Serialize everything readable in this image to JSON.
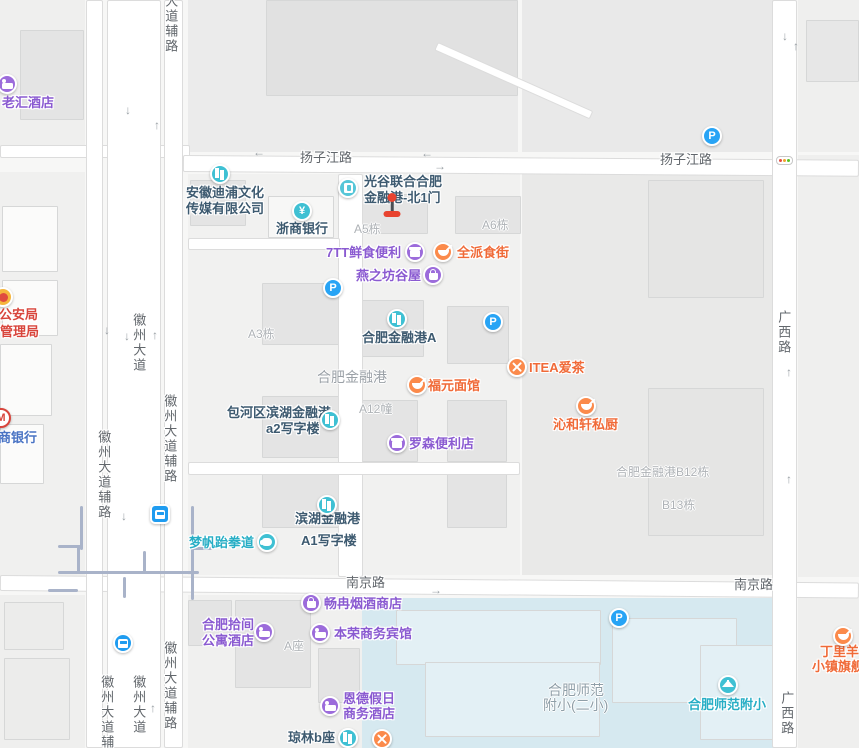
{
  "title": "合肥金融港地图",
  "colors": {
    "base": "#f7f7f6",
    "road_fill": "#ffffff",
    "road_edge": "#dcdcdc",
    "metro_line": "#a9b3c9",
    "road_label": "#62676c",
    "gray_label": "#aeb2b6",
    "area_label": "#9ba1a7",
    "school_label": "#8f9fa8",
    "marker_red": "#e8432f",
    "marker_stem": "#4a4f54",
    "tl_red": "#e54d42",
    "tl_yellow": "#f0a32f",
    "tl_green": "#58c322",
    "parking_blue": "#28a4f5",
    "mbank_red": "#d8453c"
  },
  "schemes": {
    "purple": {
      "icon": "#9c6cdb",
      "text": "#8a5ad1"
    },
    "orange": {
      "icon": "#fb8a4b",
      "text": "#f06a38"
    },
    "teal": {
      "icon": "#3fc0d3",
      "text": "#27aec5"
    },
    "dark": {
      "icon": "#3fc0d3",
      "text": "#3d5a70"
    },
    "red": {
      "icon": "#f5b53d",
      "text": "#d8453c"
    },
    "blue": {
      "icon": "#ffffff",
      "text": "#4a74c4"
    },
    "transit": {
      "icon": "#1f9cf0",
      "text": "#1f9cf0"
    }
  },
  "glyph_chars": {
    "yen": "¥",
    "parking": "P",
    "mbank": "M"
  },
  "arrow_chars": {
    "u": "↑",
    "d": "↓",
    "l": "←",
    "r": "→"
  },
  "blocks": [
    {
      "x": 0,
      "y": 0,
      "w": 85,
      "h": 148,
      "c": "#efefee"
    },
    {
      "x": 188,
      "y": 0,
      "w": 330,
      "h": 152,
      "c": "#ebebeb"
    },
    {
      "x": 522,
      "y": 0,
      "w": 252,
      "h": 152,
      "c": "#e9e9e9"
    },
    {
      "x": 798,
      "y": 0,
      "w": 61,
      "h": 152,
      "c": "#efefee"
    },
    {
      "x": 0,
      "y": 172,
      "w": 85,
      "h": 405,
      "c": "#f0f0ef"
    },
    {
      "x": 188,
      "y": 174,
      "w": 332,
      "h": 401,
      "c": "#f1f1f0"
    },
    {
      "x": 522,
      "y": 172,
      "w": 250,
      "h": 403,
      "c": "#e9e9e8"
    },
    {
      "x": 798,
      "y": 155,
      "w": 61,
      "h": 422,
      "c": "#efefee"
    },
    {
      "x": 0,
      "y": 595,
      "w": 85,
      "h": 153,
      "c": "#efefee"
    },
    {
      "x": 188,
      "y": 595,
      "w": 174,
      "h": 153,
      "c": "#f0f0ef"
    },
    {
      "x": 362,
      "y": 598,
      "w": 413,
      "h": 150,
      "c": "#d6e9f0"
    },
    {
      "x": 798,
      "y": 598,
      "w": 61,
      "h": 150,
      "c": "#efefee"
    }
  ],
  "buildings": [
    {
      "x": 20,
      "y": 30,
      "w": 64,
      "h": 90
    },
    {
      "x": 266,
      "y": 0,
      "w": 252,
      "h": 96,
      "c": "#e1e1e1"
    },
    {
      "x": 806,
      "y": 20,
      "w": 53,
      "h": 62,
      "c": "#e7e7e7"
    },
    {
      "x": 2,
      "y": 206,
      "w": 56,
      "h": 66,
      "c": "#fbfbfa"
    },
    {
      "x": 2,
      "y": 280,
      "w": 56,
      "h": 56,
      "c": "#fbfbfa"
    },
    {
      "x": 0,
      "y": 344,
      "w": 52,
      "h": 72,
      "c": "#fbfbfa"
    },
    {
      "x": 0,
      "y": 424,
      "w": 44,
      "h": 60,
      "c": "#fbfbfa"
    },
    {
      "x": 190,
      "y": 180,
      "w": 56,
      "h": 46
    },
    {
      "x": 268,
      "y": 196,
      "w": 66,
      "h": 42,
      "c": "#f7f7f6"
    },
    {
      "x": 352,
      "y": 194,
      "w": 76,
      "h": 40
    },
    {
      "x": 455,
      "y": 196,
      "w": 66,
      "h": 38
    },
    {
      "x": 262,
      "y": 283,
      "w": 78,
      "h": 62
    },
    {
      "x": 362,
      "y": 300,
      "w": 62,
      "h": 57
    },
    {
      "x": 447,
      "y": 306,
      "w": 62,
      "h": 58
    },
    {
      "x": 262,
      "y": 396,
      "w": 78,
      "h": 62
    },
    {
      "x": 358,
      "y": 400,
      "w": 60,
      "h": 62
    },
    {
      "x": 447,
      "y": 400,
      "w": 60,
      "h": 62
    },
    {
      "x": 262,
      "y": 468,
      "w": 78,
      "h": 60
    },
    {
      "x": 447,
      "y": 468,
      "w": 60,
      "h": 60
    },
    {
      "x": 648,
      "y": 180,
      "w": 116,
      "h": 118,
      "c": "#e5e5e4"
    },
    {
      "x": 648,
      "y": 388,
      "w": 116,
      "h": 148,
      "c": "#e5e5e4"
    },
    {
      "x": 235,
      "y": 600,
      "w": 76,
      "h": 88
    },
    {
      "x": 188,
      "y": 600,
      "w": 44,
      "h": 46
    },
    {
      "x": 318,
      "y": 648,
      "w": 42,
      "h": 55
    },
    {
      "x": 4,
      "y": 602,
      "w": 60,
      "h": 48,
      "c": "#ececeb"
    },
    {
      "x": 4,
      "y": 658,
      "w": 66,
      "h": 82,
      "c": "#ececeb"
    },
    {
      "x": 396,
      "y": 610,
      "w": 205,
      "h": 55,
      "c": "#e3f0f5"
    },
    {
      "x": 425,
      "y": 662,
      "w": 175,
      "h": 75,
      "c": "#e3f0f5"
    },
    {
      "x": 612,
      "y": 618,
      "w": 125,
      "h": 85,
      "c": "#e3f0f5"
    },
    {
      "x": 700,
      "y": 645,
      "w": 85,
      "h": 95,
      "c": "#e3f0f5"
    }
  ],
  "roads": [
    {
      "x": 0,
      "y": 145,
      "w": 190,
      "h": 13,
      "r": 0
    },
    {
      "x": 183,
      "y": 155,
      "w": 676,
      "h": 17,
      "r": 0.4
    },
    {
      "x": 0,
      "y": 575,
      "w": 859,
      "h": 16,
      "r": 0.5
    },
    {
      "x": 86,
      "y": 0,
      "w": 17,
      "h": 748,
      "r": 0
    },
    {
      "x": 107,
      "y": 0,
      "w": 54,
      "h": 748,
      "r": 0
    },
    {
      "x": 164,
      "y": 0,
      "w": 19,
      "h": 748,
      "r": 0
    },
    {
      "x": 772,
      "y": 0,
      "w": 25,
      "h": 748,
      "r": 0
    },
    {
      "x": 338,
      "y": 174,
      "w": 25,
      "h": 403,
      "r": 0
    },
    {
      "x": 188,
      "y": 238,
      "w": 152,
      "h": 12,
      "r": 0
    },
    {
      "x": 188,
      "y": 462,
      "w": 332,
      "h": 13,
      "r": 0
    },
    {
      "x": 438,
      "y": 42,
      "w": 170,
      "h": 9,
      "r": 24
    }
  ],
  "metro_lines": [
    {
      "x": 80,
      "y": 506,
      "w": 3,
      "h": 44
    },
    {
      "x": 58,
      "y": 545,
      "w": 23,
      "h": 3
    },
    {
      "x": 77,
      "y": 547,
      "w": 3,
      "h": 27
    },
    {
      "x": 58,
      "y": 571,
      "w": 141,
      "h": 3
    },
    {
      "x": 143,
      "y": 551,
      "w": 3,
      "h": 22
    },
    {
      "x": 123,
      "y": 577,
      "w": 3,
      "h": 21
    },
    {
      "x": 191,
      "y": 506,
      "w": 3,
      "h": 94
    },
    {
      "x": 191,
      "y": 547,
      "w": 21,
      "h": 3
    },
    {
      "x": 48,
      "y": 589,
      "w": 30,
      "h": 3
    }
  ],
  "road_labels": [
    {
      "t": "扬子江路",
      "x": 300,
      "y": 151,
      "v": 0
    },
    {
      "t": "扬子江路",
      "x": 660,
      "y": 153,
      "v": 0
    },
    {
      "t": "南京路",
      "x": 346,
      "y": 576,
      "v": 0
    },
    {
      "t": "南京路",
      "x": 734,
      "y": 578,
      "v": 0
    },
    {
      "t": "徽州大道",
      "x": 131,
      "y": 313,
      "v": 1
    },
    {
      "t": "徽州大道",
      "x": 131,
      "y": 675,
      "v": 1
    },
    {
      "t": "徽州大道辅路",
      "x": 162,
      "y": 394,
      "v": 1
    },
    {
      "t": "徽州大道辅路",
      "x": 162,
      "y": 641,
      "v": 1
    },
    {
      "t": "徽州大道辅路",
      "x": 96,
      "y": 430,
      "v": 1
    },
    {
      "t": "徽州大道辅路",
      "x": 99,
      "y": 675,
      "v": 1
    },
    {
      "t": "大道辅路",
      "x": 163,
      "y": -6,
      "v": 1
    },
    {
      "t": "广西路",
      "x": 776,
      "y": 310,
      "v": 1
    },
    {
      "t": "广西路",
      "x": 779,
      "y": 691,
      "v": 1
    }
  ],
  "gray_labels": [
    {
      "t": "A5栋",
      "x": 354,
      "y": 220
    },
    {
      "t": "A6栋",
      "x": 482,
      "y": 216
    },
    {
      "t": "A3栋",
      "x": 248,
      "y": 325
    },
    {
      "t": "A12幢",
      "x": 359,
      "y": 400
    },
    {
      "t": "A座",
      "x": 284,
      "y": 637
    },
    {
      "t": "B13栋",
      "x": 662,
      "y": 496
    },
    {
      "t": "合肥金融港B12栋",
      "x": 616,
      "y": 463
    },
    {
      "t": "合肥金融港",
      "x": 317,
      "y": 367,
      "fs": 14,
      "c": "#9ba1a7"
    },
    {
      "t": "合肥师范",
      "x": 548,
      "y": 680,
      "fs": 14,
      "c": "#8f9fa8"
    },
    {
      "t": "附小(二小)",
      "x": 543,
      "y": 695,
      "fs": 14,
      "c": "#8f9fa8"
    }
  ],
  "pois": [
    {
      "id": "laohui-hotel",
      "icon": "bed",
      "scheme": "purple",
      "cx": 7,
      "cy": 84,
      "labels": [
        {
          "t": "老汇酒店",
          "x": 2,
          "y": 96
        }
      ]
    },
    {
      "id": "police-bureau",
      "icon": "emblem",
      "scheme": "red",
      "cx": 3,
      "cy": 297,
      "labels": [
        {
          "t": "市公安局",
          "x": -14,
          "y": 308
        },
        {
          "t": "管理局",
          "x": 0,
          "y": 325
        }
      ]
    },
    {
      "id": "merchants-bank",
      "icon": "mbank",
      "scheme": "blue",
      "cx": 1,
      "cy": 418,
      "labels": [
        {
          "t": "商银行",
          "x": -2,
          "y": 431
        }
      ]
    },
    {
      "id": "dipu-media",
      "icon": "bldg",
      "scheme": "dark",
      "cx": 220,
      "cy": 174,
      "labels": [
        {
          "t": "安徽迪浦文化",
          "x": 186,
          "y": 186
        },
        {
          "t": "传媒有限公司",
          "x": 186,
          "y": 202
        }
      ]
    },
    {
      "id": "zheshang-bank",
      "icon": "yen",
      "scheme": "dark",
      "cx": 302,
      "cy": 211,
      "labels": [
        {
          "t": "浙商银行",
          "x": 276,
          "y": 222
        }
      ]
    },
    {
      "id": "finance-port-north-gate1",
      "icon": "door",
      "scheme": "dark",
      "ic": "#55c6d8",
      "cx": 348,
      "cy": 188,
      "labels": [
        {
          "t": "光谷联合合肥",
          "x": 364,
          "y": 175
        },
        {
          "t": "金融港-北1门",
          "x": 364,
          "y": 191
        }
      ]
    },
    {
      "id": "7tt-store",
      "icon": "shop",
      "scheme": "purple",
      "cx": 415,
      "cy": 252,
      "labels": [
        {
          "t": "7TT鲜食便利",
          "x": 326,
          "y": 246
        }
      ]
    },
    {
      "id": "quanpai-food-street",
      "icon": "food",
      "scheme": "orange",
      "cx": 443,
      "cy": 252,
      "labels": [
        {
          "t": "全派食街",
          "x": 457,
          "y": 246
        }
      ]
    },
    {
      "id": "yanzhifang",
      "icon": "bag",
      "scheme": "purple",
      "cx": 433,
      "cy": 275,
      "labels": [
        {
          "t": "燕之坊谷屋",
          "x": 356,
          "y": 269
        }
      ]
    },
    {
      "id": "finance-port-a",
      "icon": "bldg",
      "scheme": "dark",
      "cx": 397,
      "cy": 319,
      "labels": [
        {
          "t": "合肥金融港A",
          "x": 362,
          "y": 331
        }
      ]
    },
    {
      "id": "fuyuan-noodle",
      "icon": "bowl",
      "scheme": "orange",
      "cx": 417,
      "cy": 385,
      "labels": [
        {
          "t": "福元面馆",
          "x": 428,
          "y": 379
        }
      ]
    },
    {
      "id": "itea",
      "icon": "ut",
      "scheme": "orange",
      "cx": 517,
      "cy": 367,
      "labels": [
        {
          "t": "ITEA爱茶",
          "x": 529,
          "y": 361
        }
      ]
    },
    {
      "id": "qinhexuan",
      "icon": "bowl",
      "scheme": "orange",
      "cx": 586,
      "cy": 406,
      "labels": [
        {
          "t": "沁和轩私厨",
          "x": 553,
          "y": 418
        }
      ]
    },
    {
      "id": "a2-office",
      "icon": "bldg",
      "scheme": "dark",
      "cx": 330,
      "cy": 420,
      "labels": [
        {
          "t": "包河区滨湖金融港",
          "x": 227,
          "y": 406
        },
        {
          "t": "a2写字楼",
          "x": 266,
          "y": 422
        }
      ]
    },
    {
      "id": "lawson",
      "icon": "shop",
      "scheme": "purple",
      "cx": 397,
      "cy": 443,
      "labels": [
        {
          "t": "罗森便利店",
          "x": 409,
          "y": 437
        }
      ]
    },
    {
      "id": "a1-office",
      "icon": "bldg",
      "scheme": "dark",
      "cx": 327,
      "cy": 505,
      "labels": [
        {
          "t": "滨湖金融港",
          "x": 295,
          "y": 512
        },
        {
          "t": "A1写字楼",
          "x": 301,
          "y": 534
        }
      ]
    },
    {
      "id": "mengfan-taekwondo",
      "icon": "fist",
      "scheme": "teal",
      "cx": 267,
      "cy": 542,
      "labels": [
        {
          "t": "梦帆跆拳道",
          "x": 189,
          "y": 536
        }
      ]
    },
    {
      "id": "metro-entrance",
      "icon": "bus",
      "sq": 1,
      "scheme": "transit",
      "cx": 160,
      "cy": 514,
      "labels": []
    },
    {
      "id": "bus-stop",
      "icon": "bus",
      "scheme": "transit",
      "cx": 123,
      "cy": 643,
      "labels": []
    },
    {
      "id": "changran-tobacco",
      "icon": "bag",
      "scheme": "purple",
      "cx": 311,
      "cy": 603,
      "labels": [
        {
          "t": "畅冉烟酒商店",
          "x": 324,
          "y": 597
        }
      ]
    },
    {
      "id": "shijian-apartment-hotel",
      "icon": "bed",
      "scheme": "purple",
      "cx": 264,
      "cy": 632,
      "labels": [
        {
          "t": "合肥拾间",
          "x": 202,
          "y": 618
        },
        {
          "t": "公寓酒店",
          "x": 202,
          "y": 634
        }
      ]
    },
    {
      "id": "benrong-hotel",
      "icon": "bed",
      "scheme": "purple",
      "cx": 320,
      "cy": 633,
      "labels": [
        {
          "t": "本荣商务宾馆",
          "x": 334,
          "y": 627
        }
      ]
    },
    {
      "id": "ende-holiday-hotel",
      "icon": "bed",
      "scheme": "purple",
      "cx": 330,
      "cy": 706,
      "labels": [
        {
          "t": "恩德假日",
          "x": 343,
          "y": 692
        },
        {
          "t": "商务酒店",
          "x": 343,
          "y": 707
        }
      ]
    },
    {
      "id": "qionglin-b",
      "icon": "bldg",
      "scheme": "dark",
      "cx": 348,
      "cy": 738,
      "labels": [
        {
          "t": "琼林b座",
          "x": 288,
          "y": 731
        }
      ]
    },
    {
      "id": "restaurant-unnamed",
      "icon": "ut",
      "scheme": "orange",
      "cx": 382,
      "cy": 739,
      "labels": []
    },
    {
      "id": "normal-primary-school",
      "icon": "school",
      "scheme": "teal",
      "cx": 728,
      "cy": 685,
      "labels": [
        {
          "t": "合肥师范附小",
          "x": 688,
          "y": 698
        }
      ]
    },
    {
      "id": "dingliyang",
      "icon": "bowl",
      "scheme": "orange",
      "cx": 843,
      "cy": 636,
      "labels": [
        {
          "t": "丁里羊",
          "x": 820,
          "y": 645
        },
        {
          "t": "小镇旗舰",
          "x": 812,
          "y": 660
        }
      ]
    }
  ],
  "parkings": [
    {
      "x": 333,
      "y": 288
    },
    {
      "x": 493,
      "y": 322
    },
    {
      "x": 712,
      "y": 136
    },
    {
      "x": 619,
      "y": 618
    }
  ],
  "arrows": [
    {
      "x": 125,
      "y": 104,
      "d": "d"
    },
    {
      "x": 154,
      "y": 119,
      "d": "u"
    },
    {
      "x": 253,
      "y": 146,
      "d": "l"
    },
    {
      "x": 421,
      "y": 147,
      "d": "l"
    },
    {
      "x": 434,
      "y": 160,
      "d": "r"
    },
    {
      "x": 782,
      "y": 30,
      "d": "d"
    },
    {
      "x": 793,
      "y": 40,
      "d": "u"
    },
    {
      "x": 104,
      "y": 324,
      "d": "d"
    },
    {
      "x": 124,
      "y": 330,
      "d": "d"
    },
    {
      "x": 152,
      "y": 329,
      "d": "u"
    },
    {
      "x": 786,
      "y": 366,
      "d": "u"
    },
    {
      "x": 786,
      "y": 473,
      "d": "u"
    },
    {
      "x": 150,
      "y": 702,
      "d": "u"
    },
    {
      "x": 121,
      "y": 510,
      "d": "d"
    },
    {
      "x": 430,
      "y": 584,
      "d": "r"
    }
  ],
  "marker": {
    "x": 392,
    "y": 193
  },
  "traffic_light": {
    "x": 776,
    "y": 156
  }
}
